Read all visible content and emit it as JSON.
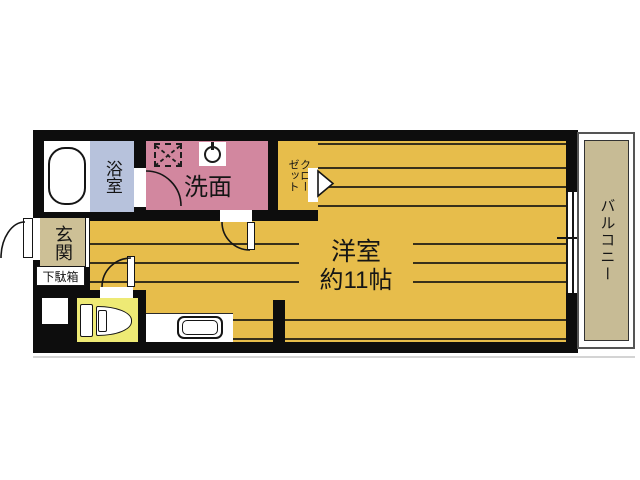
{
  "plan": {
    "rooms": {
      "bathroom": {
        "label": "浴室"
      },
      "washroom": {
        "label": "洗面"
      },
      "closet": {
        "label": "クロー\nゼット"
      },
      "entrance": {
        "label": "玄関"
      },
      "shoe_cabinet": {
        "label": "下駄箱"
      },
      "main_room": {
        "label": "洋室",
        "size_label": "約11帖"
      },
      "balcony": {
        "label": "バルコニー"
      }
    },
    "icons": {
      "bathtub": "bathtub-icon",
      "washing_machine_space": "washer-space-icon",
      "washbasin": "washbasin-icon",
      "toilet": "toilet-icon",
      "kitchen_sink": "kitchen-sink-icon",
      "closet_folding_door": "folding-door-arrow-icon",
      "door_swing": "door-swing-arc-icon",
      "sliding_window": "sliding-window-icon"
    },
    "colors": {
      "wall": "#0d0d0d",
      "floor": "#e7bd4b",
      "floor_line": "#38301a",
      "bath": "#b7c2dc",
      "wash": "#d2879f",
      "genkan": "#cdc096",
      "balcony": "#c7bb95",
      "toilet": "#eeea75"
    }
  }
}
